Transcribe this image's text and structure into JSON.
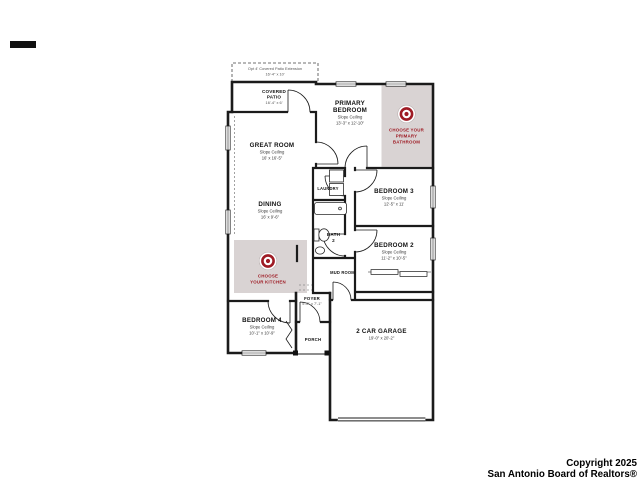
{
  "colors": {
    "accent": "#9e1b24",
    "gray": "#d9d3d3",
    "wall": "#1b1b1b"
  },
  "optional_patio": {
    "line1": "Opt 4' Covered Patio Extension",
    "line2": "16'-4\" x 10'"
  },
  "rooms": {
    "covered_patio": {
      "name1": "COVERED",
      "name2": "PATIO",
      "dims": "16'-4\" x 6'"
    },
    "primary_bedroom": {
      "name1": "PRIMARY",
      "name2": "BEDROOM",
      "ceiling": "Slope Ceiling",
      "dims": "13'-3\" x 12'-10\""
    },
    "great_room": {
      "name": "GREAT ROOM",
      "ceiling": "Slope Ceiling",
      "dims": "16' x 16'-5\""
    },
    "dining": {
      "name": "DINING",
      "ceiling": "Slope Ceiling",
      "dims": "16' x 9'-6\""
    },
    "laundry": {
      "name": "LAUNDRY"
    },
    "bedroom_3": {
      "name": "BEDROOM 3",
      "ceiling": "Slope Ceiling",
      "dims": "12'-5\" x 11'"
    },
    "bath_2": {
      "name1": "BATH",
      "name2": "2"
    },
    "bedroom_2": {
      "name": "BEDROOM 2",
      "ceiling": "Slope Ceiling",
      "dims": "11'-2\" x 10'-5\""
    },
    "mud_room": {
      "name": "MUD ROOM"
    },
    "foyer": {
      "name": "FOYER",
      "dims": "5'-2\" x 7'-1\""
    },
    "bedroom_4": {
      "name": "BEDROOM 4",
      "ceiling": "Slope Ceiling",
      "dims": "10'-1\" x 10'-9\""
    },
    "porch": {
      "name": "PORCH"
    },
    "garage": {
      "name": "2 CAR GARAGE",
      "dims": "19'-0\" x 20'-2\""
    }
  },
  "callouts": {
    "kitchen": {
      "line1": "CHOOSE",
      "line2": "YOUR KITCHEN"
    },
    "primary_bath": {
      "line1": "CHOOSE YOUR",
      "line2": "PRIMARY",
      "line3": "BATHROOM"
    }
  },
  "footer": {
    "line1": "Copyright 2025",
    "line2": "San Antonio Board of Realtors®"
  }
}
